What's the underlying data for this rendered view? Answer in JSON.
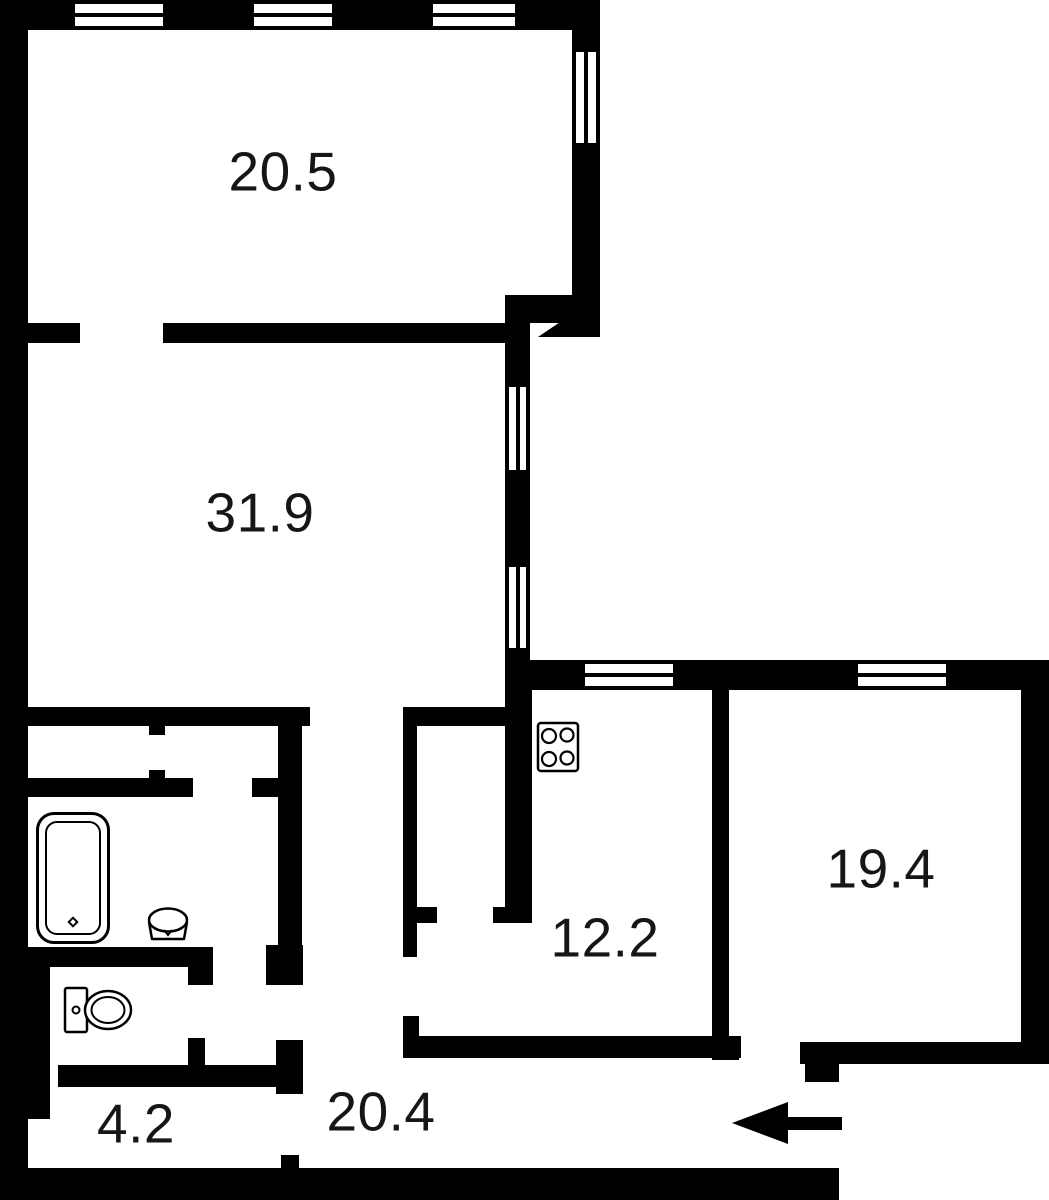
{
  "meta": {
    "type": "apartment floor plan",
    "background_color": "#ffffff",
    "wall_color": "#000000",
    "label_color": "#161616"
  },
  "rooms": [
    {
      "id": "room-top-left",
      "label": "20.5"
    },
    {
      "id": "room-living",
      "label": "31.9"
    },
    {
      "id": "kitchen",
      "label": "12.2"
    },
    {
      "id": "room-right",
      "label": "19.4"
    },
    {
      "id": "wc-room",
      "label": "4.2"
    },
    {
      "id": "hallway",
      "label": "20.4"
    }
  ],
  "fixtures": [
    {
      "id": "bathtub-icon"
    },
    {
      "id": "washbasin-icon"
    },
    {
      "id": "toilet-icon"
    },
    {
      "id": "stove-icon"
    }
  ],
  "entrance": {
    "symbol": "arrow-left"
  }
}
